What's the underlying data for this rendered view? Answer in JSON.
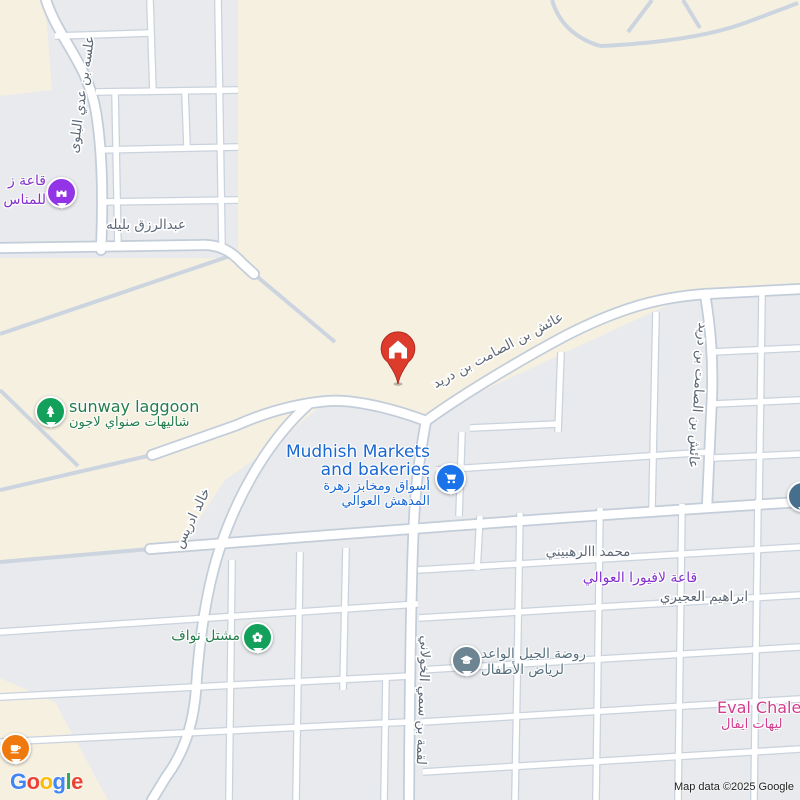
{
  "map": {
    "attribution": "Map data ©2025 Google",
    "logo_letters": [
      "G",
      "o",
      "o",
      "g",
      "l",
      "e"
    ]
  },
  "streets": {
    "alasah_bin_adi": "علسه بن عدي البلوى",
    "abdulrazzaq_balilah": "عبدالرزق بليله",
    "aish_bin_alsamit_diagonal": "عائش بن الصامت بن دريد",
    "aish_bin_alsamit_vertical": "عائش بن الصامت بن دريد",
    "khalid_idris": "خالد ادريس",
    "mohammed_alrahbini": "محمد االرهبيني",
    "ibrahim_alajiri": "ابراهيم العجيري",
    "luqmah_bin_sumay": "لقمة بن سمي الخولاني"
  },
  "pois": {
    "wedding_hall": {
      "line1": "قاعة ز",
      "line2": "للمناس"
    },
    "sunway_lagoon": {
      "title": "sunway laggoon",
      "subtitle": "شاليهات صنواي لاجون"
    },
    "mudhish_markets": {
      "title_line1": "Mudhish Markets",
      "title_line2": "and bakeries",
      "subtitle_line1": "أسواق ومخابز زهرة",
      "subtitle_line2": "المدهش العوالي"
    },
    "nawaf_nursery": {
      "title": "مشتل نواف"
    },
    "kindergarten": {
      "line1": "روضة الجيل الواعد",
      "line2": "لرياض الأطفال"
    },
    "lafiora_hall": {
      "title": "قاعة لافيورا العوالي"
    },
    "eval_chalet": {
      "title": "Eval Chale",
      "subtitle": "ليهات ايفال"
    }
  },
  "colors": {
    "land_beige": "#f6f0e1",
    "block_gray": "#e8eaed",
    "road_casing": "#c6cfda",
    "street_text": "#5d6876",
    "green_poi_text": "#237c4b",
    "green_pin": "#12a05a",
    "blue_poi_text": "#1967d2",
    "blue_pin": "#1a73e8",
    "purple_poi_text": "#8430ce",
    "purple_pin": "#9334e6",
    "slate_poi_text": "#566f7d",
    "slate_pin": "#6d8492",
    "pink_poi_text": "#d13d8e",
    "orange_pin": "#ef790e",
    "destination_red": "#dd3b2c"
  }
}
